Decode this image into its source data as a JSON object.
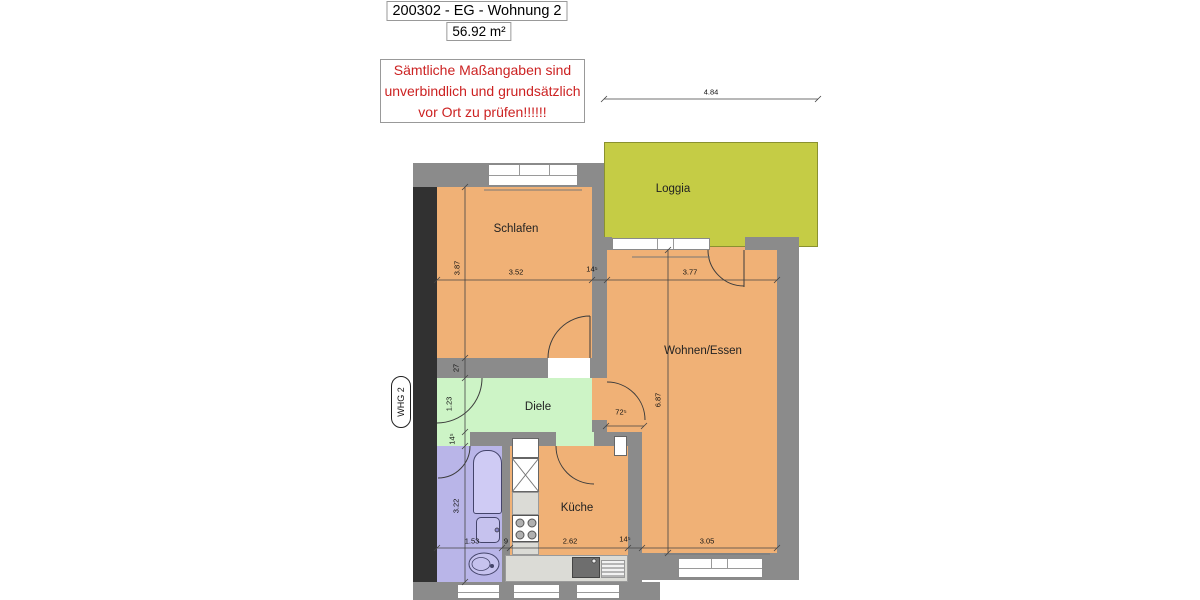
{
  "header": {
    "title": "200302 - EG - Wohnung 2",
    "area": "56.92 m²"
  },
  "warning": {
    "line1": "Sämtliche Maßangaben sind",
    "line2": "unverbindlich und grundsätzlich",
    "line3": "vor Ort zu prüfen!!!!!!"
  },
  "unit_badge": "WHG 2",
  "rooms": {
    "schlafen": "Schlafen",
    "loggia": "Loggia",
    "wohnen_essen": "Wohnen/Essen",
    "diele": "Diele",
    "kueche": "Küche"
  },
  "dims": {
    "loggia_width": "4.84",
    "schlafen_width": "3.52",
    "schlafen_depth": "3.87",
    "wall_schlafen_we": "14⁵",
    "we_width": "3.77",
    "we_depth": "6.87",
    "diele_wall_top": "27",
    "diele_depth": "1.23",
    "diele_wall_bottom": "14⁵",
    "we_door": "72⁵",
    "bad_depth": "3.22",
    "bad_width": "1.53",
    "partition": "9",
    "kueche_width": "2.62",
    "wall_kueche_we": "14⁵",
    "we_bottom": "3.05"
  },
  "colors": {
    "room_fill": "#f0b176",
    "loggia_fill": "#c5cc45",
    "diele_fill": "#cdf4c6",
    "bad_fill": "#b9b5e8",
    "wall": "#8b8b8b",
    "dark_wall": "#313131",
    "warning_text": "#cc2222"
  }
}
